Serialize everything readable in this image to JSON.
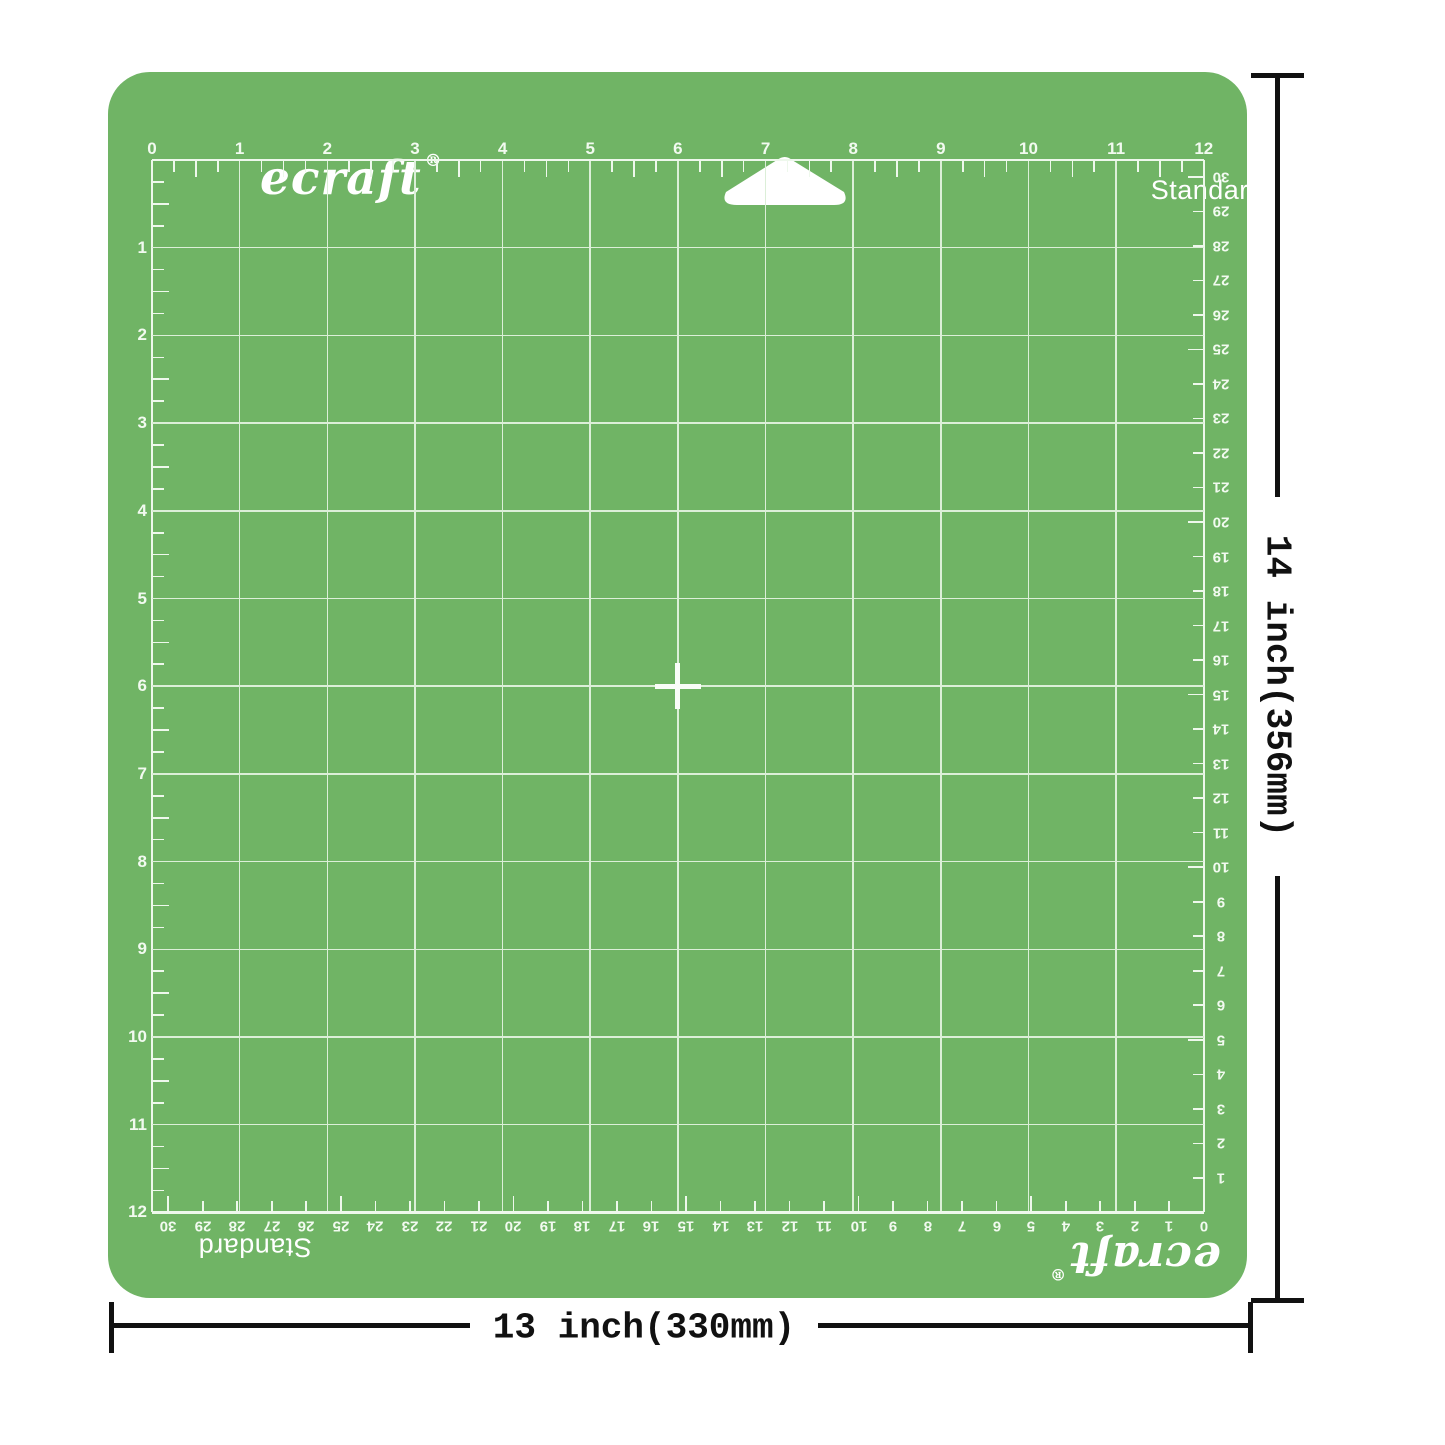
{
  "page": {
    "background": "#ffffff"
  },
  "mat": {
    "brand": "ecraft",
    "registered_mark": "®",
    "variant": "Standard",
    "colors": {
      "mat_green": "#70b465",
      "grid_line": "#dcefd8",
      "grid_border_line": "#eef8ec",
      "ruler_text": "#f2faf0",
      "label_white": "#ffffff",
      "dimension_ink": "#111111",
      "page_background": "#ffffff"
    }
  },
  "grid": {
    "columns": 12,
    "rows": 12,
    "inch_top_labels": [
      "0",
      "1",
      "2",
      "3",
      "4",
      "5",
      "6",
      "7",
      "8",
      "9",
      "10",
      "11",
      "12"
    ],
    "inch_left_labels": [
      "1",
      "2",
      "3",
      "4",
      "5",
      "6",
      "7",
      "8",
      "9",
      "10",
      "11",
      "12"
    ],
    "cm_bottom_labels": [
      "30",
      "29",
      "28",
      "27",
      "26",
      "25",
      "24",
      "23",
      "22",
      "21",
      "20",
      "19",
      "18",
      "17",
      "16",
      "15",
      "14",
      "13",
      "12",
      "11",
      "10",
      "9",
      "8",
      "7",
      "6",
      "5",
      "4",
      "3",
      "2",
      "1",
      "0"
    ],
    "cm_right_labels": [
      "30",
      "29",
      "28",
      "27",
      "26",
      "25",
      "24",
      "23",
      "22",
      "21",
      "20",
      "19",
      "18",
      "17",
      "16",
      "15",
      "14",
      "13",
      "12",
      "11",
      "10",
      "9",
      "8",
      "7",
      "6",
      "5",
      "4",
      "3",
      "2",
      "1"
    ]
  },
  "bottom_edge": {
    "variant": "Standard",
    "brand": "ecraft",
    "registered_mark": "®"
  },
  "annotations": {
    "height_label": "14 inch(356mm)",
    "width_label": "13 inch(330mm)"
  }
}
